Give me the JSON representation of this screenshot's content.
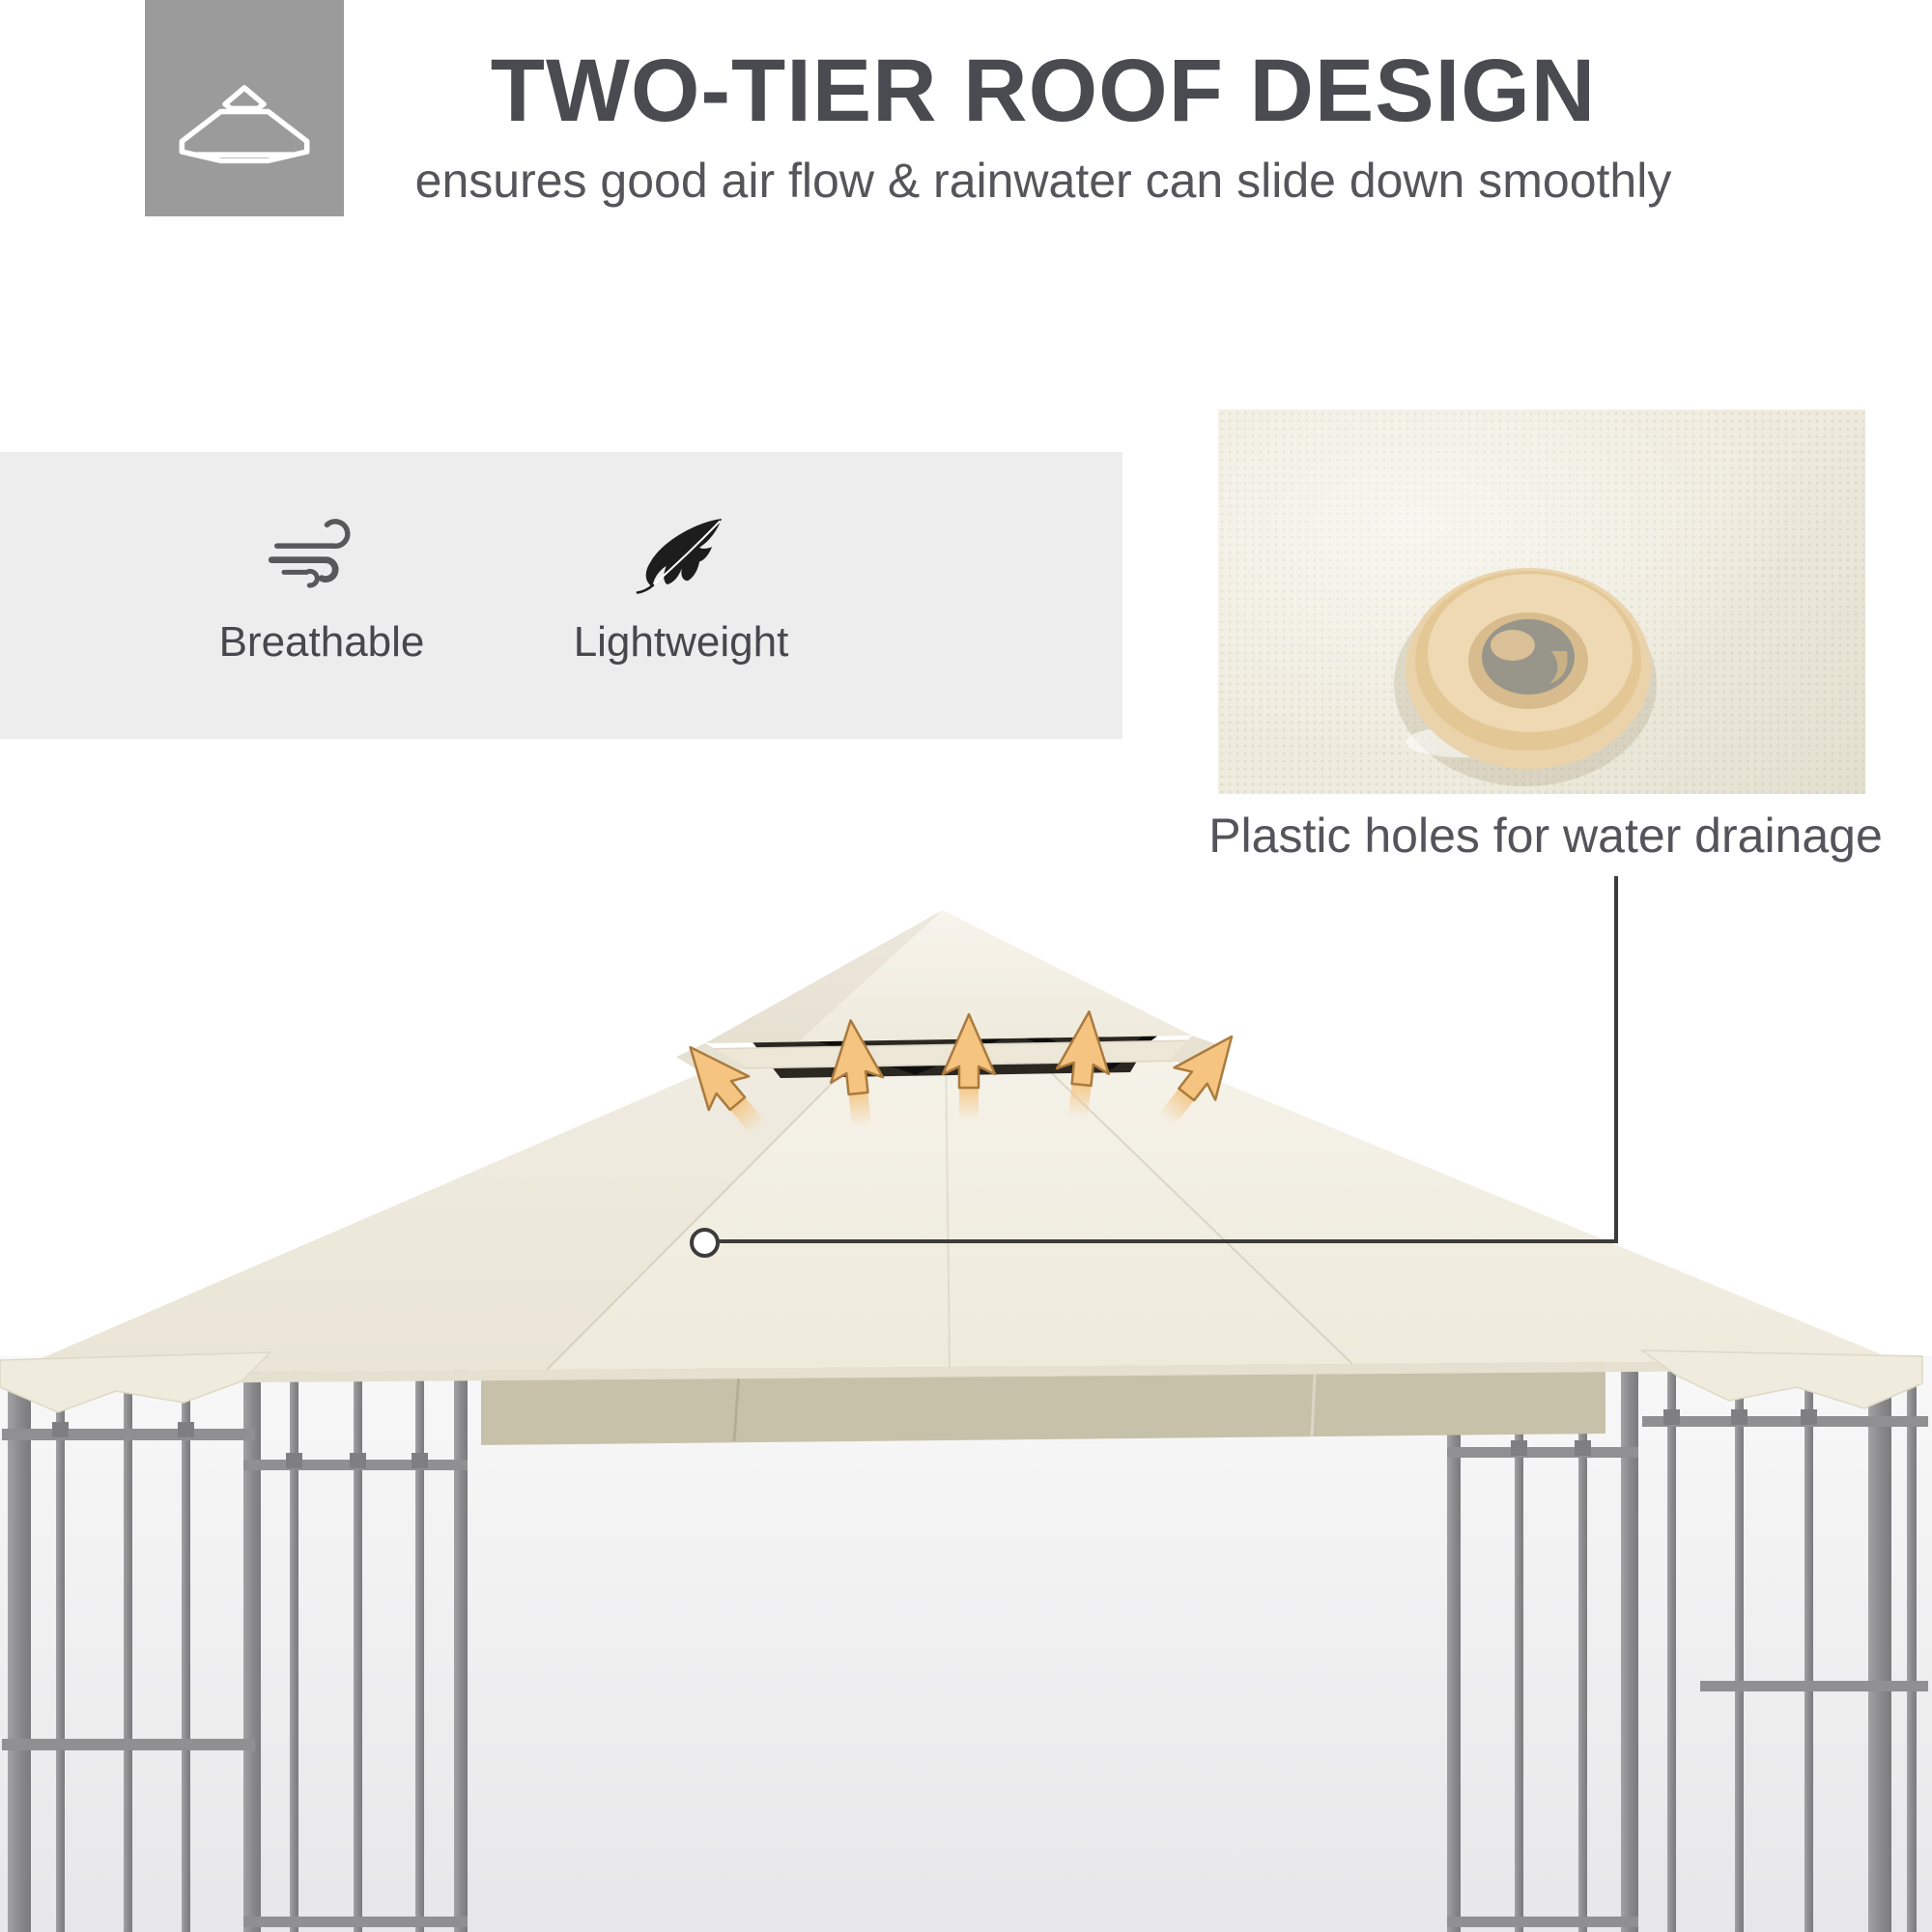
{
  "header": {
    "title": "TWO-TIER ROOF DESIGN",
    "subtitle": "ensures good air flow & rainwater can slide down smoothly",
    "tile_icon": "two-tier-roof-icon"
  },
  "features": {
    "items": [
      {
        "label": "Breathable",
        "icon": "wind-icon"
      },
      {
        "label": "Lightweight",
        "icon": "feather-icon"
      }
    ]
  },
  "callout": {
    "caption": "Plastic holes for water drainage",
    "marker": "circle-marker-on-roof",
    "image": "canopy-fabric-drain-hole-photo"
  },
  "illustration": {
    "subject": "two-tier gazebo canopy on steel lattice frame",
    "airflow_arrows": 5
  },
  "colors": {
    "title_text": "#4a4a51",
    "body_text": "#55555a",
    "tile_bg": "#9b9b9b",
    "band_bg": "#ededee",
    "canopy_cream": "#f2efe5",
    "canopy_underside": "#c8c1a9",
    "vent_dark": "#2b2721",
    "arrow_orange": "#f5c480",
    "metal_gray": "#8b8b8e",
    "leader_line": "#3c3c3c"
  }
}
